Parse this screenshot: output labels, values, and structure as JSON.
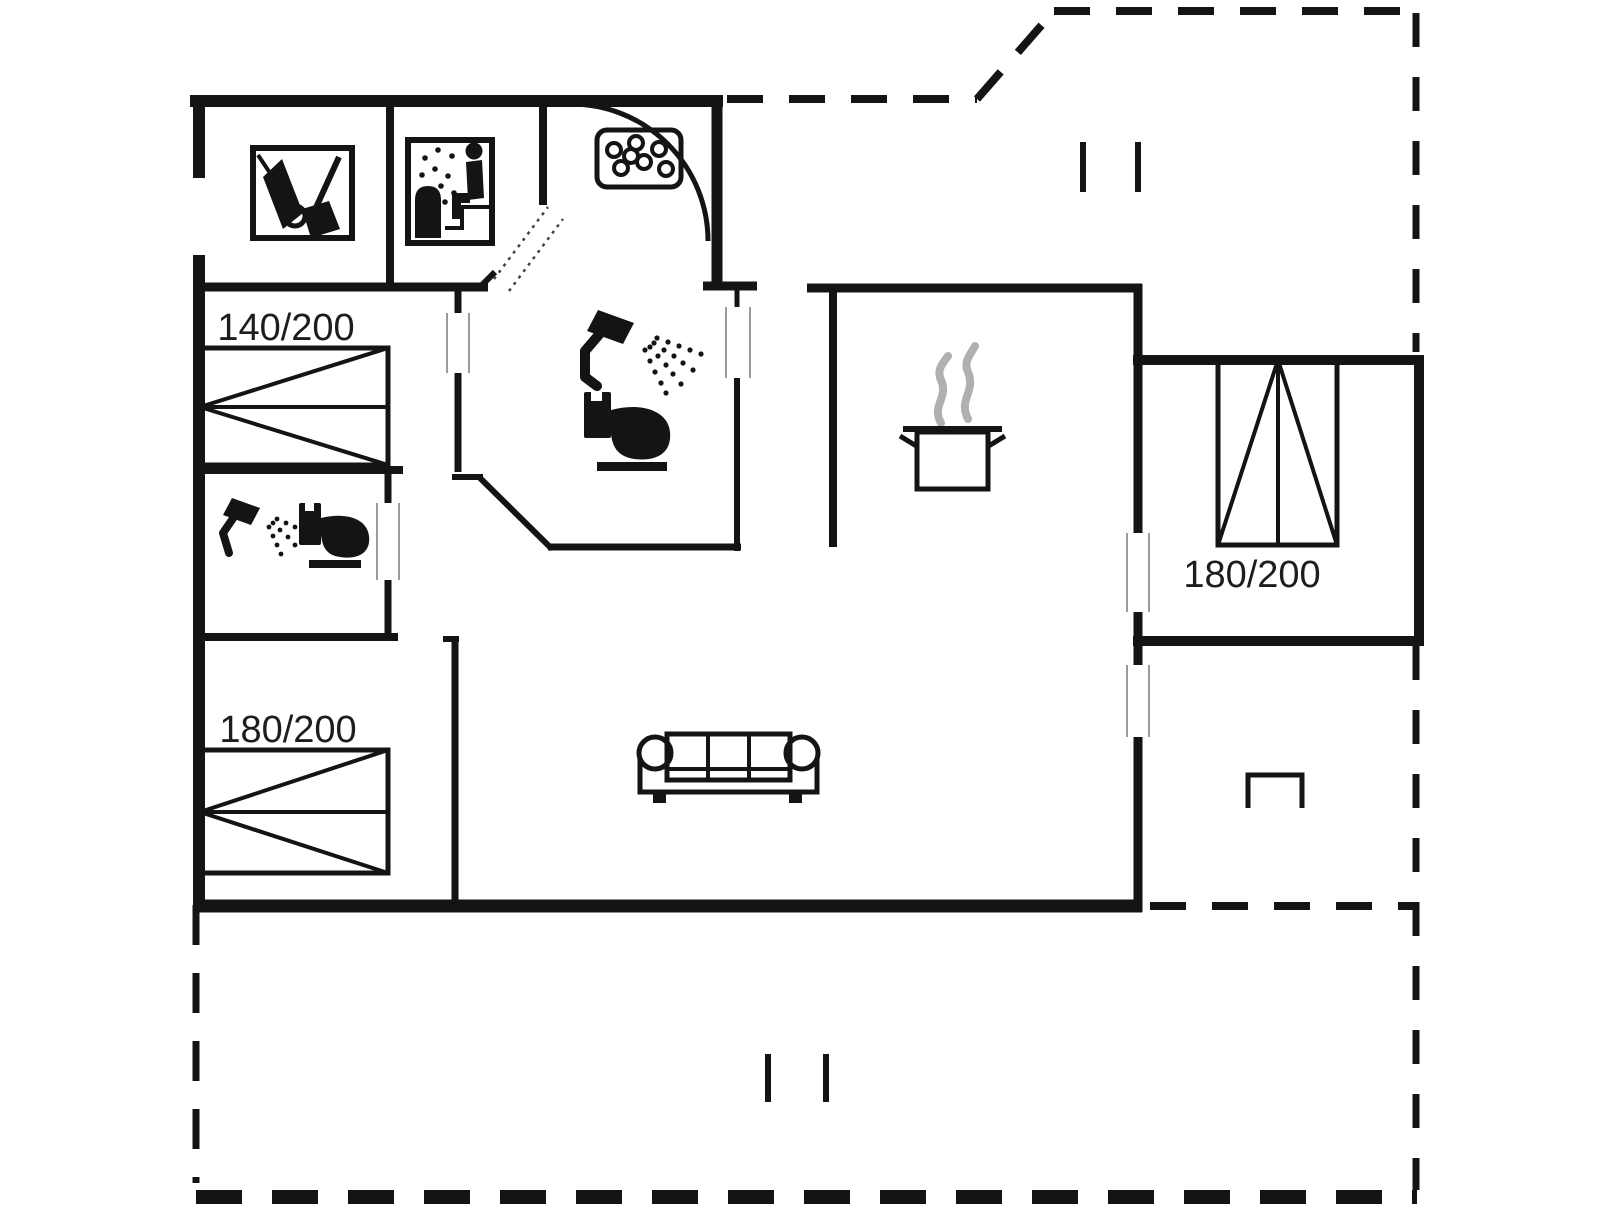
{
  "colors": {
    "wall": "#141414",
    "background": "#ffffff",
    "steam": "#b0b0b0",
    "window_marker": "#9b9b9b"
  },
  "labels": {
    "bed_140": "140/200",
    "bed_180_left": "180/200",
    "bed_180_right": "180/200"
  },
  "icons": {
    "utility": "vacuum-broom-icon",
    "sauna": "sauna-icon",
    "spa": "spa-bubbles-icon",
    "shower_main": "shower-icon",
    "toilet_main": "toilet-icon",
    "shower_second": "shower-icon",
    "toilet_second": "toilet-icon",
    "stove": "steaming-pot-icon",
    "sofa": "sofa-icon",
    "terrace_marker": "grill-marker-icon"
  }
}
